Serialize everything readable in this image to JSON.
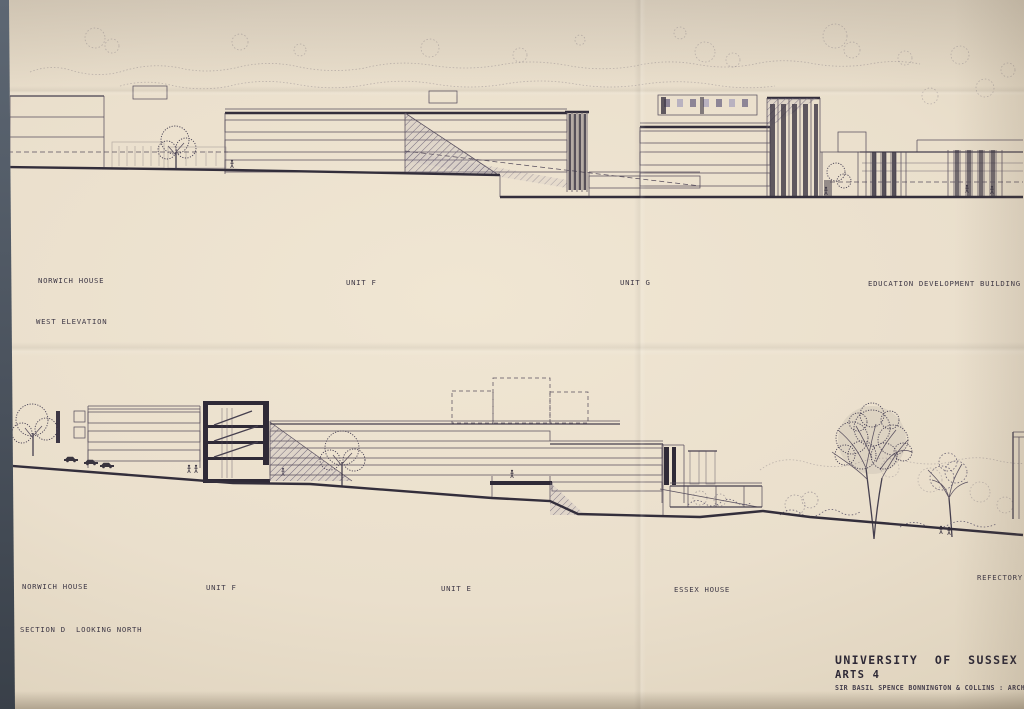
{
  "sheet": {
    "west_elevation": {
      "caption": "WEST ELEVATION",
      "labels": [
        {
          "name": "norwich-house",
          "text": "NORWICH HOUSE"
        },
        {
          "name": "unit-f",
          "text": "UNIT F"
        },
        {
          "name": "unit-g",
          "text": "UNIT G"
        },
        {
          "name": "education-development-building",
          "text": "EDUCATION DEVELOPMENT BUILDING"
        }
      ]
    },
    "section": {
      "caption": "SECTION D  LOOKING NORTH",
      "labels": [
        {
          "name": "norwich-house",
          "text": "NORWICH HOUSE"
        },
        {
          "name": "unit-f",
          "text": "UNIT F"
        },
        {
          "name": "unit-e",
          "text": "UNIT E"
        },
        {
          "name": "essex-house",
          "text": "ESSEX HOUSE"
        },
        {
          "name": "refectory",
          "text": "REFECTORY"
        }
      ]
    },
    "title_block": {
      "line1": "UNIVERSITY  OF  SUSSEX",
      "line2": "ARTS 4",
      "line3": "SIR BASIL SPENCE BONNINGTON & COLLINS : ARCHITECTS"
    },
    "colors": {
      "paper": "#eadfcc",
      "ink": "#4a4454",
      "poche": "#2f2a37",
      "background_table": "#4a525d"
    }
  }
}
